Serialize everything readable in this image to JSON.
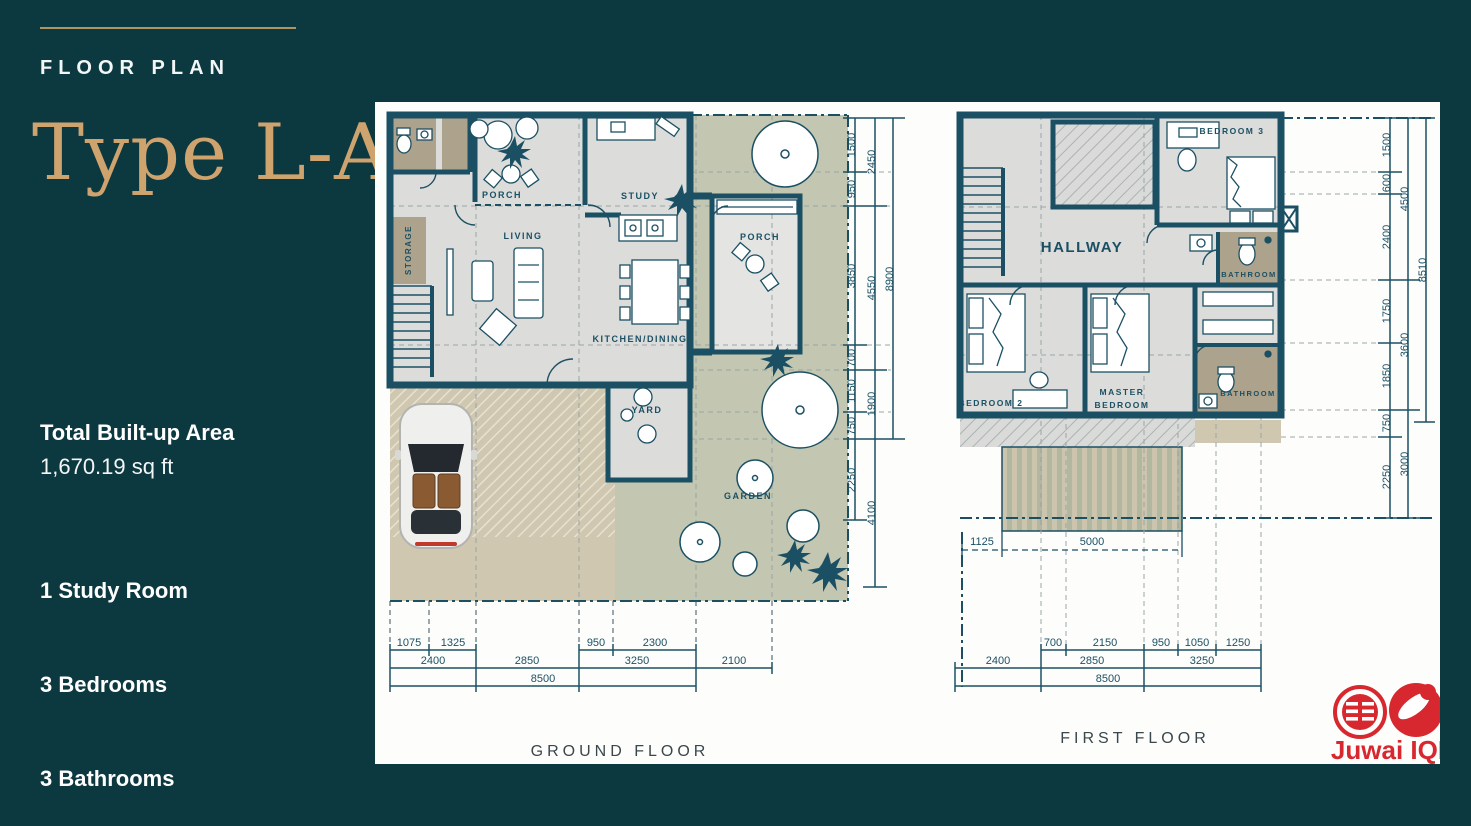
{
  "sidebar": {
    "header": "FLOOR PLAN",
    "type_title": "Type L-A",
    "area_label": "Total Built-up Area",
    "area_value": "1,670.19 sq ft",
    "features": [
      "1 Study Room",
      "3 Bedrooms",
      "3 Bathrooms"
    ]
  },
  "ground_floor": {
    "title": "GROUND FLOOR",
    "rooms": {
      "storage": "STORAGE",
      "porch_left": "PORCH",
      "living": "LIVING",
      "study": "STUDY",
      "porch_right": "PORCH",
      "kitchen": "KITCHEN/DINING",
      "yard": "YARD",
      "garden": "GARDEN"
    },
    "dims_right_inner": [
      "1500",
      "950",
      "3850",
      "700",
      "1150",
      "750",
      "2250"
    ],
    "dims_right_mid": [
      "2450",
      "4550",
      "1900",
      "4100"
    ],
    "dims_right_outer": [
      "8900"
    ],
    "dims_bottom_row1": [
      "1075",
      "1325",
      "950",
      "2300"
    ],
    "dims_bottom_row2": [
      "2400",
      "2850",
      "3250",
      "2100"
    ],
    "dims_bottom_row3": [
      "8500"
    ]
  },
  "first_floor": {
    "title": "FIRST FLOOR",
    "rooms": {
      "bedroom3": "BEDROOM 3",
      "hallway": "HALLWAY",
      "bathroom_top": "BATHROOM",
      "bedroom2": "BEDROOM 2",
      "master_line1": "MASTER",
      "master_line2": "BEDROOM",
      "bathroom_bottom": "BATHROOM"
    },
    "dims_right_inner": [
      "1500",
      "600",
      "2400",
      "1750",
      "1850",
      "750",
      "2250"
    ],
    "dims_right_mid": [
      "4500",
      "3600",
      "3000"
    ],
    "dims_right_outer": [
      "8510"
    ],
    "dims_balcony": [
      "1125",
      "5000"
    ],
    "dims_bottom_row1": [
      "700",
      "2150",
      "950",
      "1050",
      "1250"
    ],
    "dims_bottom_row2": [
      "2400",
      "2850",
      "3250"
    ],
    "dims_bottom_row3": [
      "8500"
    ]
  },
  "logo": {
    "brand": "Juwai IQI"
  },
  "colors": {
    "background_teal": "#0c3840",
    "wall_teal": "#1b5064",
    "gold": "#cfa36d",
    "garden_green": "#c3c7b1",
    "driveway_tan": "#cfc7b0",
    "bath_brown": "#ada28c",
    "logo_red": "#d7282f"
  }
}
